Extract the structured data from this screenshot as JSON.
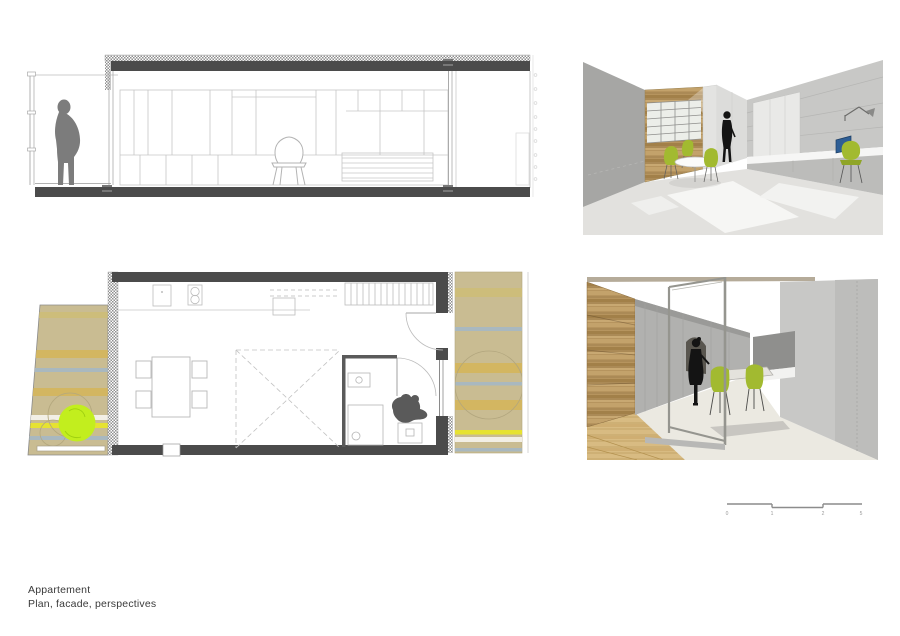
{
  "sheet": {
    "title": "Appartement",
    "subtitle": "Plan, facade, perspectives"
  },
  "scale_bar": {
    "labels": [
      "0",
      "1",
      "2",
      "5"
    ]
  },
  "palette": {
    "wall_dark": "#4b4b4b",
    "wall_mid": "#8f8f8d",
    "line_gray": "#b0b0b0",
    "line_light": "#d4d4d4",
    "terrace_tan": "#c9bc92",
    "stripe_ochre": "#d3b661",
    "stripe_ochre_soft": "#cdbd7a",
    "stripe_bluegray": "#a9b8bf",
    "stripe_yellow": "#e6e232",
    "stripe_white": "#f2efe6",
    "tree_green": "#c2ee1e",
    "chair_green": "#a2ba30",
    "chair_green_dark": "#8fa527",
    "wood_brown": "#b6945e",
    "wood_floor": "#d8bb82",
    "laptop_blue": "#2e5e95",
    "figure_gray": "#7c7c7c",
    "figure_dark": "#141414",
    "plan_figure": "#5a5a5a",
    "persp_wall_light": "#c8c8c6",
    "persp_wall_mid": "#b1b1af",
    "persp_wall_deep": "#a6a6a4",
    "persp_floor": "#ebe9e1",
    "text_color": "#3a3a3a",
    "scale_text": "#9a9a9a"
  }
}
